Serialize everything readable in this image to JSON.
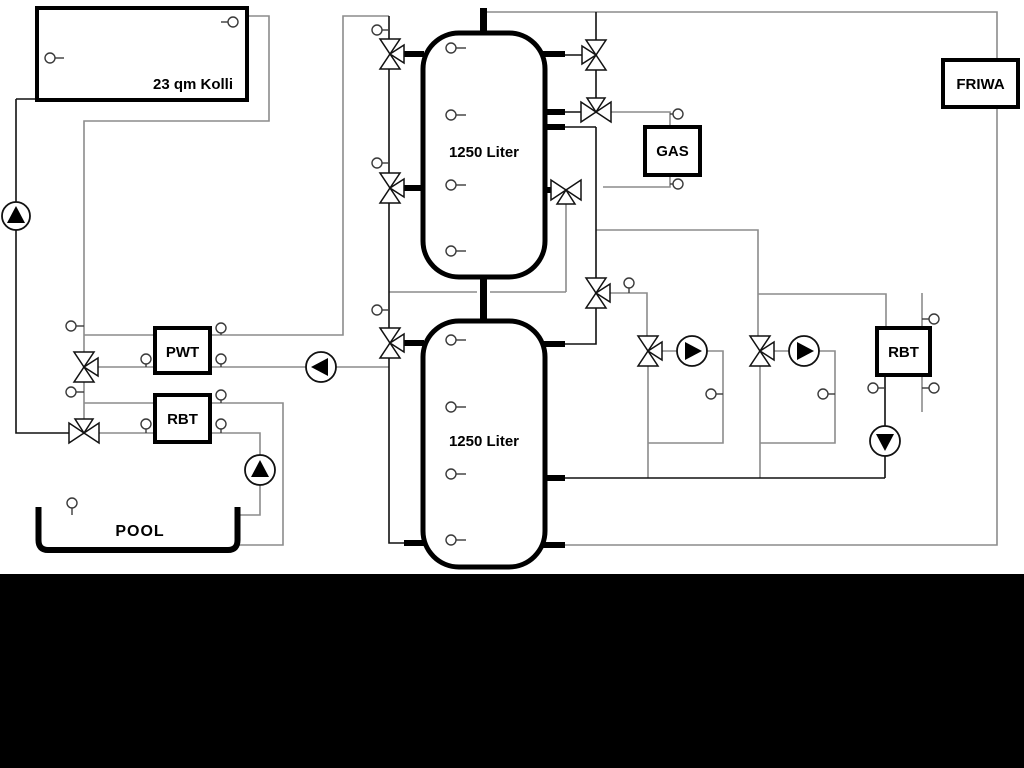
{
  "labels": {
    "collector": "23 qm Kolli",
    "tank_upper": "1250 Liter",
    "tank_lower": "1250 Liter",
    "gas": "GAS",
    "friwa": "FRIWA",
    "pwt": "PWT",
    "rbt_left": "RBT",
    "rbt_right": "RBT",
    "pool": "POOL"
  },
  "equipment": {
    "pumps": [
      {
        "id": "solar-pump",
        "flow": "up"
      },
      {
        "id": "pwt-charge-pump",
        "flow": "left"
      },
      {
        "id": "pool-pump",
        "flow": "up"
      },
      {
        "id": "heating-circuit-1-pump",
        "flow": "right"
      },
      {
        "id": "heating-circuit-2-pump",
        "flow": "right"
      },
      {
        "id": "rbt-right-pump",
        "flow": "down"
      }
    ],
    "three_way_valves": 11,
    "temperature_sensors": 30
  },
  "colors": {
    "line_black": "#111111",
    "line_gray": "#8c8c8c",
    "background": "#ffffff",
    "letterbox_bar": "#000000"
  }
}
